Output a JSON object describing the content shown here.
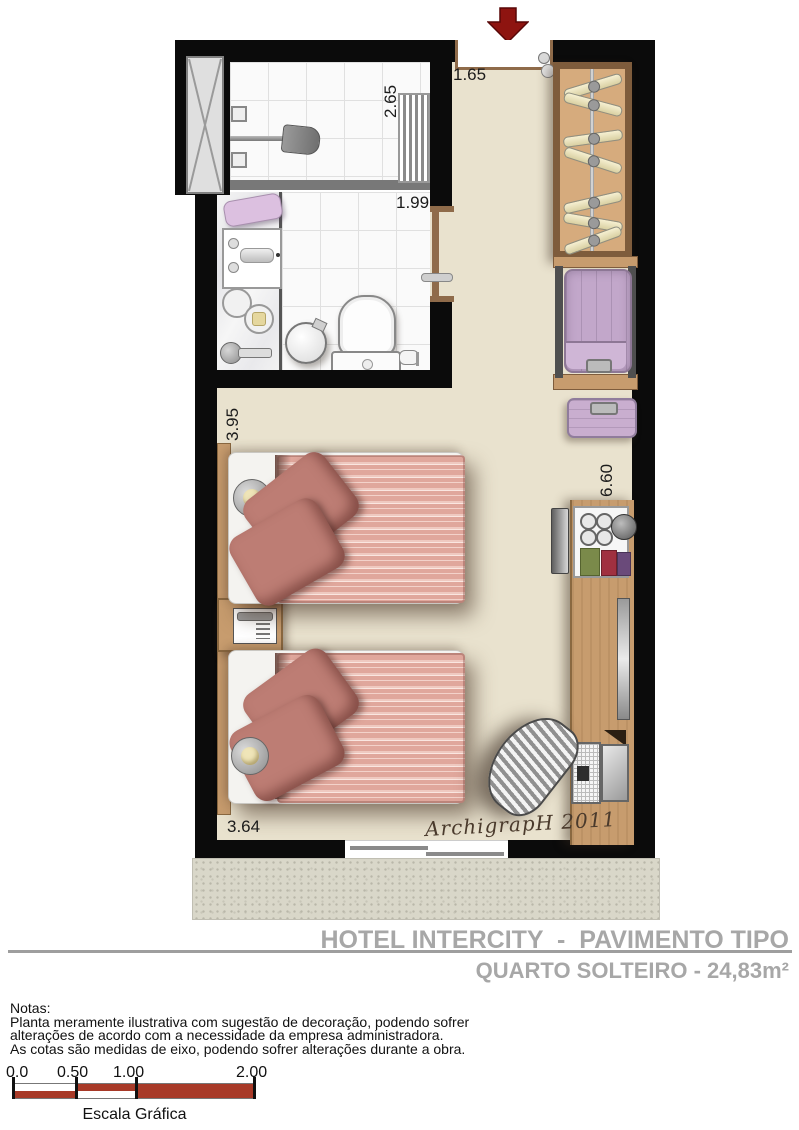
{
  "plan": {
    "dimensions": {
      "shower": "2.65",
      "entry": "1.65",
      "bathroom": "1.99",
      "bedroom_left": "3.95",
      "room_right": "6.60",
      "bedroom_bottom": "3.64"
    },
    "signature": "ArchigrapH 2011"
  },
  "title_block": {
    "line1": "HOTEL INTERCITY  -  PAVIMENTO TIPO",
    "line2": "QUARTO SOLTEIRO - 24,83m²"
  },
  "notes": {
    "heading": "Notas:",
    "lines": [
      "Planta meramente ilustrativa com sugestão de decoração, podendo sofrer",
      "alterações de acordo com a necessidade da empresa administradora.",
      "As cotas são medidas de eixo, podendo sofrer alterações durante a obra."
    ]
  },
  "scale_bar": {
    "labels": [
      "0.0",
      "0.50",
      "1.00",
      "2.00"
    ],
    "caption": "Escala Gráfica"
  },
  "colors": {
    "wall": "#0b0b0b",
    "floor": "#E9E2CE",
    "wood": "#C79C6E",
    "wood_dark": "#8A6840",
    "duvet": "#E0A79C",
    "pillow": "#BD7D74",
    "suitcase": "#C2A7CA",
    "scale_red": "#A83A28",
    "arrow_red": "#8E1410",
    "title_gray": "#A7A7A7"
  }
}
